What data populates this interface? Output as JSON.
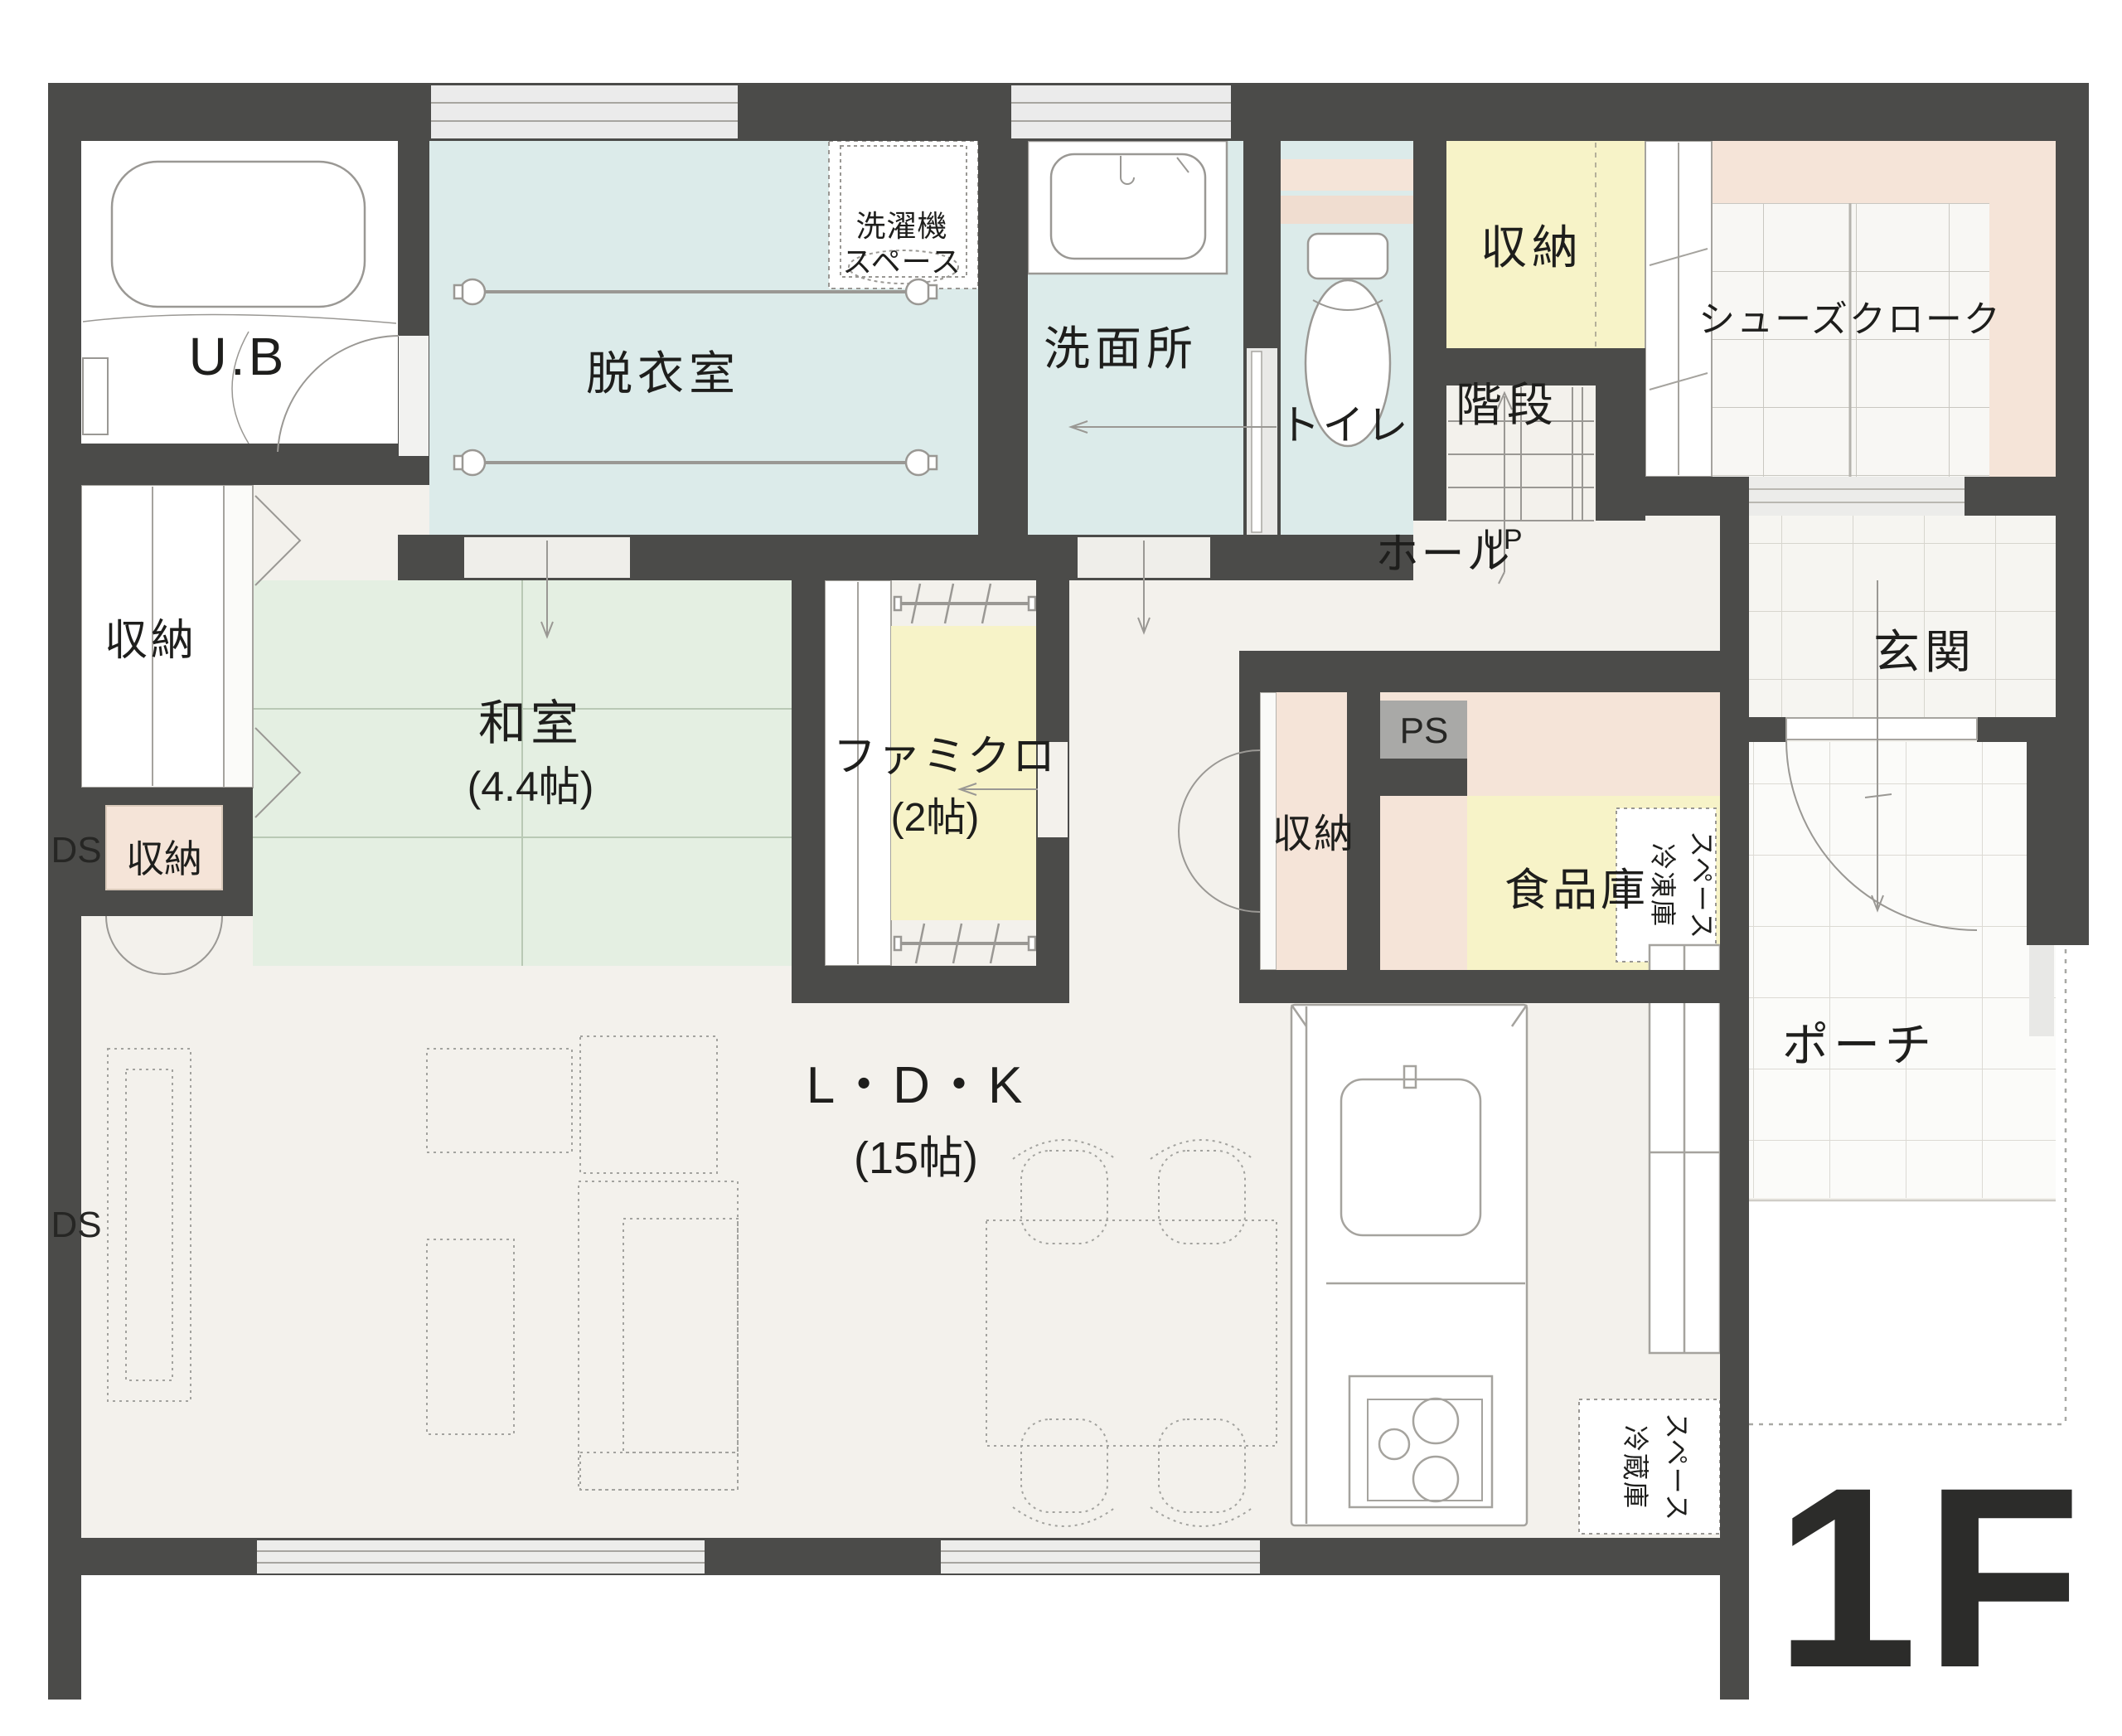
{
  "floor": {
    "tag": "1F"
  },
  "labels": {
    "ub": "U.B",
    "dressing_room": "脱衣室",
    "washer_space_1": "洗濯機",
    "washer_space_2": "スペース",
    "washroom": "洗面所",
    "toilet": "トイレ",
    "storage_top_right": "収納",
    "stairs": "階段",
    "up": "UP",
    "shoes_cloak": "シューズクローク",
    "entrance": "玄関",
    "hall": "ホール",
    "porch": "ポーチ",
    "storage_left": "収納",
    "storage_ds": "収納",
    "ds_upper": "DS",
    "ds_lower": "DS",
    "japanese_room": "和室",
    "japanese_room_size": "(4.4帖)",
    "family_closet": "ファミクロ",
    "family_closet_size": "(2帖)",
    "storage_band": "収納",
    "ps": "PS",
    "pantry": "食品庫",
    "freezer_1": "冷凍庫",
    "freezer_2": "スペース",
    "ldk": "L・D・K",
    "ldk_size": "(15帖)",
    "fridge_1": "冷蔵庫",
    "fridge_2": "スペース"
  },
  "colors": {
    "wall": "#4b4b49",
    "floor": "#f3f1ec",
    "wet_room_blue": "#dcebea",
    "tatami_green": "#e4efe2",
    "storage_yellow": "#f7f3c8",
    "closet_pink": "#f5e4d8",
    "ps_gray": "#a9a9a7",
    "window_gray": "#ebebeb"
  }
}
